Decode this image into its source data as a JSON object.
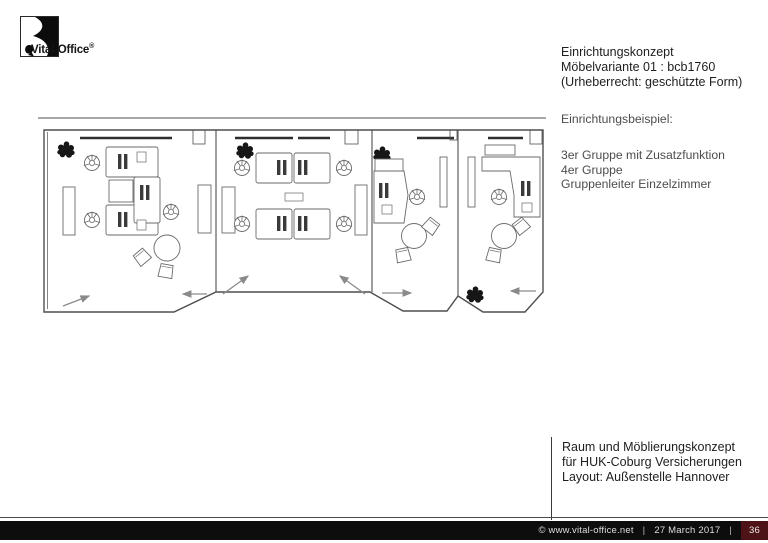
{
  "logo": {
    "brand": "Vital-Office",
    "reg": "®"
  },
  "concept_block": {
    "lines": [
      "Einrichtungskonzept",
      "Möbelvariante 01 : bcb1760",
      "(Urheberrecht: geschützte Form)"
    ]
  },
  "example_block": {
    "title": "Einrichtungsbeispiel:",
    "items": [
      "3er Gruppe mit Zusatzfunktion",
      "4er Gruppe",
      "Gruppenleiter Einzelzimmer"
    ]
  },
  "project_block": {
    "lines": [
      "Raum und Möblierungskonzept",
      "für HUK-Coburg Versicherungen",
      "Layout: Außenstelle Hannover"
    ]
  },
  "footer": {
    "copyright": "©  www.vital-office.net",
    "separator": "|",
    "date": "27 March 2017",
    "page_number": "36",
    "colors": {
      "bar": "#0d0d0d",
      "text": "#dedede",
      "page_box": "#4e1316"
    }
  },
  "floorplan": {
    "drawing_type": "CAD top view, office furniture layout",
    "stroke_color": "#5a5a5a",
    "rooms": [
      {
        "label": "3er Gruppe mit Zusatzfunktion",
        "workstations": 3,
        "meeting_table": 1,
        "visitor_chairs": 2,
        "cabinets": 2,
        "plants": 1,
        "door_arrows": 2
      },
      {
        "label": "4er Gruppe",
        "workstations": 4,
        "meeting_table": 0,
        "visitor_chairs": 0,
        "cabinets": 2,
        "plants": 1,
        "door_arrows": 2
      },
      {
        "label": "Gruppenleiter Einzelzimmer",
        "workstations": 1,
        "meeting_table": 1,
        "visitor_chairs": 2,
        "cabinets": 1,
        "plants": 1,
        "door_arrows": 1
      },
      {
        "label": "Gruppenleiter Einzelzimmer",
        "workstations": 1,
        "meeting_table": 1,
        "visitor_chairs": 2,
        "cabinets": 1,
        "plants": 1,
        "door_arrows": 1
      }
    ]
  }
}
